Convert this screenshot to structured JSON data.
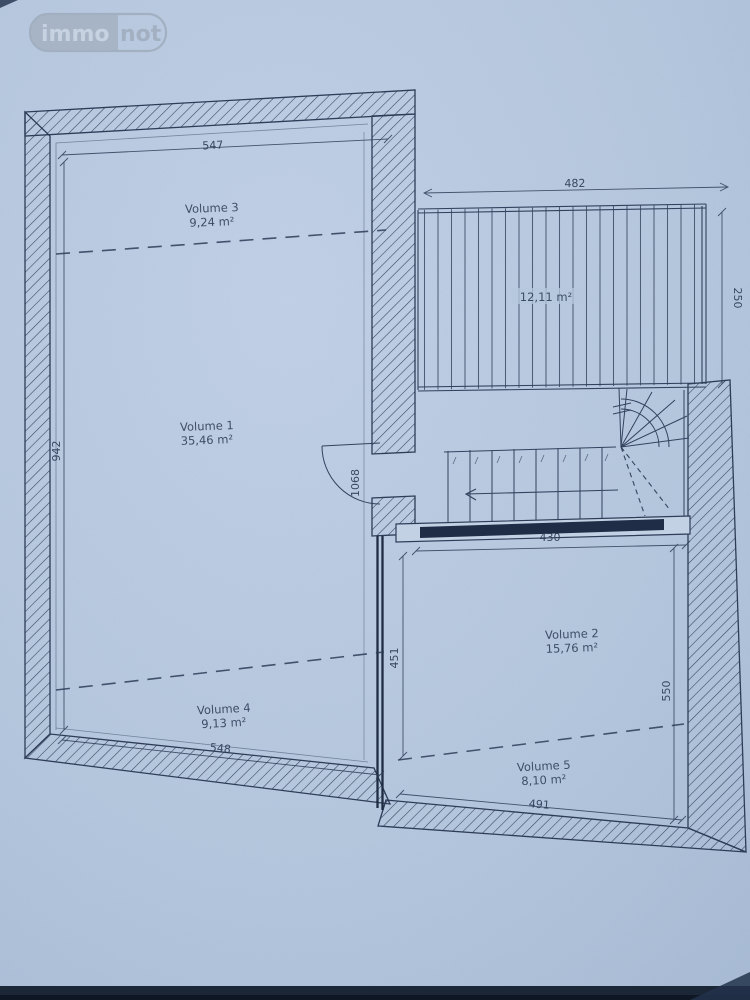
{
  "watermark": {
    "left": "immo",
    "right": "not"
  },
  "rooms": {
    "v1": {
      "name": "Volume 1",
      "area": "35,46 m²"
    },
    "v2": {
      "name": "Volume 2",
      "area": "15,76 m²"
    },
    "v3": {
      "name": "Volume 3",
      "area": "9,24 m²"
    },
    "v4": {
      "name": "Volume 4",
      "area": "9,13 m²"
    },
    "v5": {
      "name": "Volume 5",
      "area": "8,10 m²"
    },
    "terrace": {
      "area": "12,11 m²"
    }
  },
  "dimensions": {
    "top_width": "547",
    "left_height": "942",
    "bottom_width": "548",
    "terrace_width": "482",
    "terrace_depth": "250",
    "hall_width": "430",
    "door_height": "1068",
    "inner_height": "451",
    "right_height": "550",
    "bottom_right_width": "491"
  },
  "colors": {
    "paper": "#b7c8df",
    "ink": "#2e3c57",
    "wall_line": "#33425e"
  }
}
